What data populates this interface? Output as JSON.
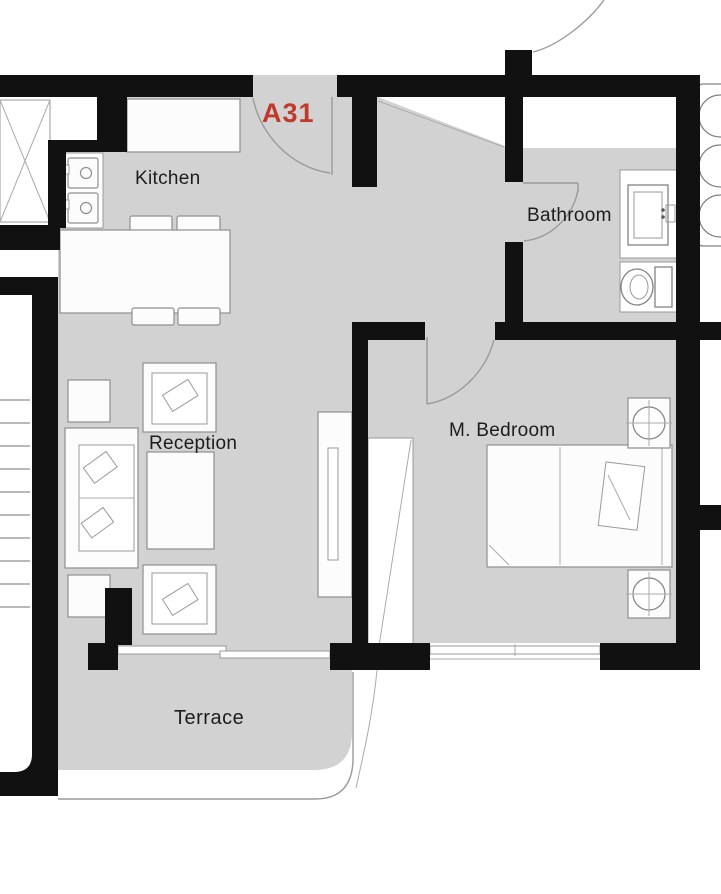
{
  "floor_plan": {
    "unit_label": "A31",
    "unit_label_color": "#c0392b",
    "rooms": {
      "kitchen": {
        "label": "Kitchen"
      },
      "reception": {
        "label": "Reception"
      },
      "bathroom": {
        "label": "Bathroom"
      },
      "master_bedroom": {
        "label": "M. Bedroom"
      },
      "terrace": {
        "label": "Terrace"
      }
    },
    "colors": {
      "wall": "#111111",
      "floor": "#d2d2d2",
      "furniture_fill": "#fcfcfc",
      "detail_line": "#9a9a9a",
      "label_text": "#1c1c1c"
    }
  }
}
